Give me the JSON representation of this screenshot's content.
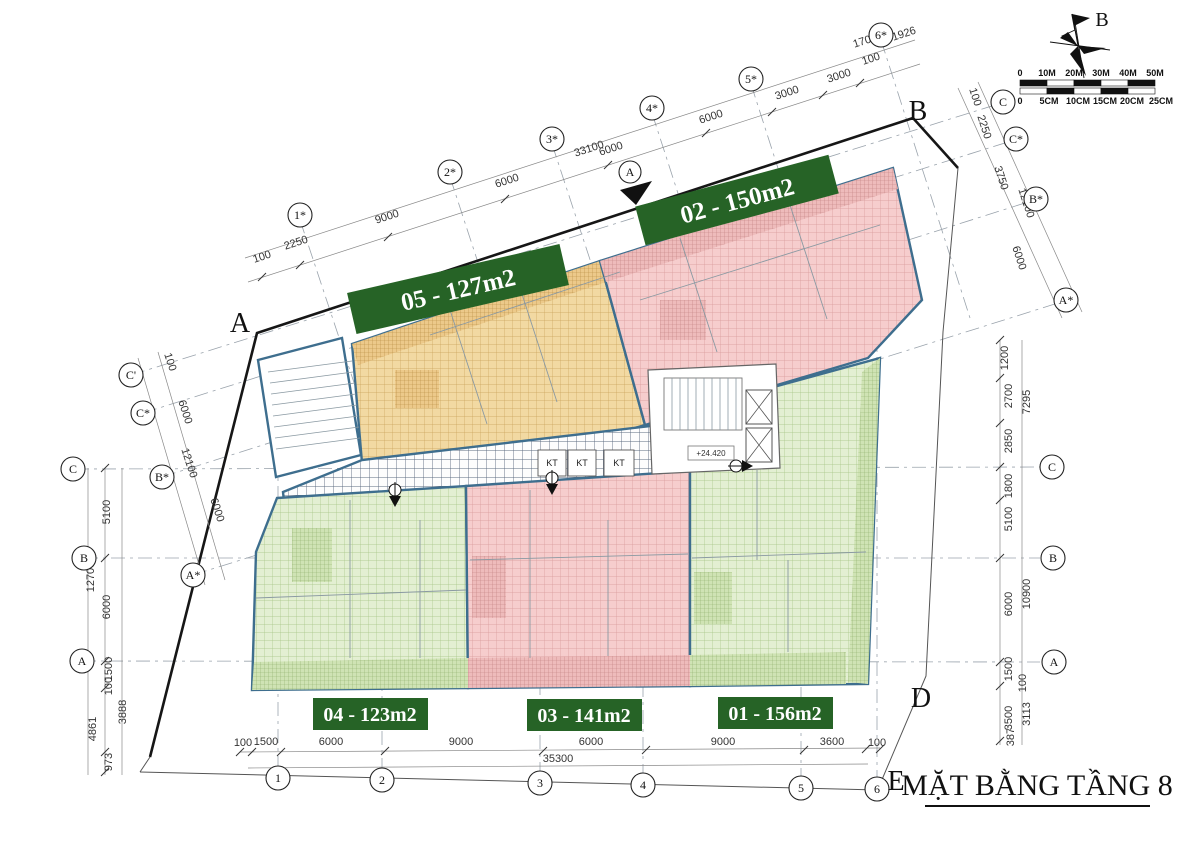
{
  "title": "MẶT BẰNG TẦNG 8",
  "compass": {
    "north_label": "B"
  },
  "scalebar": {
    "meters": [
      "0",
      "10M",
      "20M",
      "30M",
      "40M",
      "50M"
    ],
    "cms": [
      "0",
      "5CM",
      "10CM",
      "15CM",
      "20CM",
      "25CM"
    ]
  },
  "units": [
    {
      "code": "05",
      "label": "05 - 127m2"
    },
    {
      "code": "02",
      "label": "02 - 150m2"
    },
    {
      "code": "04",
      "label": "04 - 123m2"
    },
    {
      "code": "03",
      "label": "03 - 141m2"
    },
    {
      "code": "01",
      "label": "01 - 156m2"
    }
  ],
  "colors": {
    "label_bg": "#266326",
    "unit_orange": "#f2d9a2",
    "unit_pink": "#f6cdcd",
    "unit_green": "#e3efd2",
    "wall_blue": "#3e6e8e"
  },
  "core": {
    "kt1": "KT",
    "kt2": "KT",
    "kt3": "KT",
    "level": "+24.420",
    "section_mark": "A"
  },
  "corner_letters": {
    "a": "A",
    "b": "B",
    "d": "D",
    "e": "E"
  },
  "axes": {
    "top_bubbles": [
      "1*",
      "2*",
      "3*",
      "4*",
      "5*",
      "6*"
    ],
    "bottom_bubbles": [
      "1",
      "2",
      "3",
      "4",
      "5",
      "6"
    ],
    "left_vert_bubbles": [
      "C",
      "B",
      "A"
    ],
    "right_vert_bubbles": [
      "C",
      "B",
      "A"
    ],
    "left_tilt_bubbles": [
      "C'",
      "C*",
      "B*",
      "A*"
    ],
    "right_tilt_bubbles": [
      "C",
      "C*",
      "B*",
      "A*"
    ]
  },
  "dims": {
    "top": [
      "100",
      "2250",
      "9000",
      "6000",
      "6000",
      "6000",
      "3000",
      "3000",
      "100",
      "1700",
      "1926"
    ],
    "top_total": "33100",
    "bottom": [
      "100",
      "1500",
      "6000",
      "9000",
      "6000",
      "9000",
      "3600",
      "100"
    ],
    "bottom_total": "35300",
    "left_vert": [
      "5100",
      "12700",
      "6000",
      "1500",
      "100",
      "3888",
      "4861",
      "973"
    ],
    "left_tilt": [
      "100",
      "6000",
      "12100",
      "6000"
    ],
    "right_vert": [
      "1200",
      "2700",
      "7295",
      "2850",
      "1800",
      "5100",
      "10900",
      "6000",
      "1500",
      "100",
      "3500",
      "3113",
      "387"
    ],
    "right_tilt": [
      "100",
      "2250",
      "3750",
      "12100",
      "6000"
    ]
  }
}
